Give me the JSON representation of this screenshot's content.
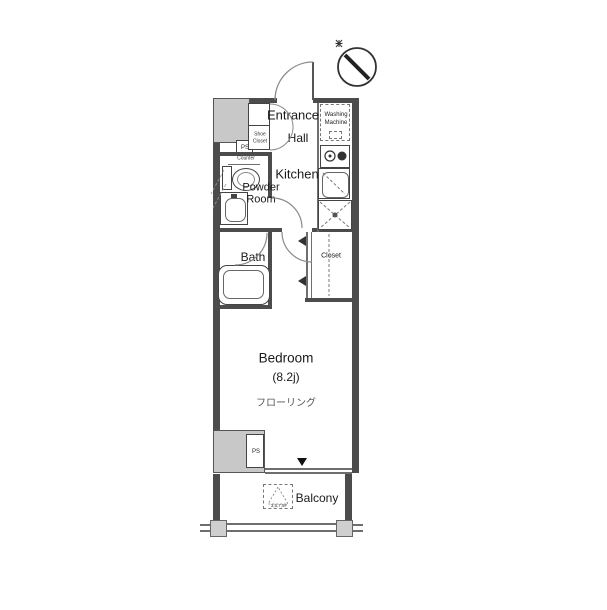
{
  "plan": {
    "type": "floorplan",
    "rooms": {
      "entrance": "Entrance",
      "hall": "Hall",
      "kitchen": "Kitchen",
      "powder_room_line1": "Powder",
      "powder_room_line2": "Room",
      "bath": "Bath",
      "closet": "Closet",
      "bedroom_line1": "Bedroom",
      "bedroom_line2": "(8.2j)",
      "bedroom_flooring": "フローリング",
      "balcony": "Balcony"
    },
    "fixtures": {
      "washing_machine_line1": "Washing",
      "washing_machine_line2": "Machine",
      "shoe_closet_line1": "Shoe",
      "shoe_closet_line2": "Closet",
      "counter": "Counter",
      "ps_top": "PS",
      "ps_bottom": "PS",
      "evacuation_hatch_floors": "3,5,7,9F"
    },
    "colors": {
      "wall": "#4c4c4c",
      "pillar_fill": "#c8c8c8",
      "line": "#6e6e6e",
      "background": "#ffffff",
      "text": "#1a1a1a"
    }
  }
}
